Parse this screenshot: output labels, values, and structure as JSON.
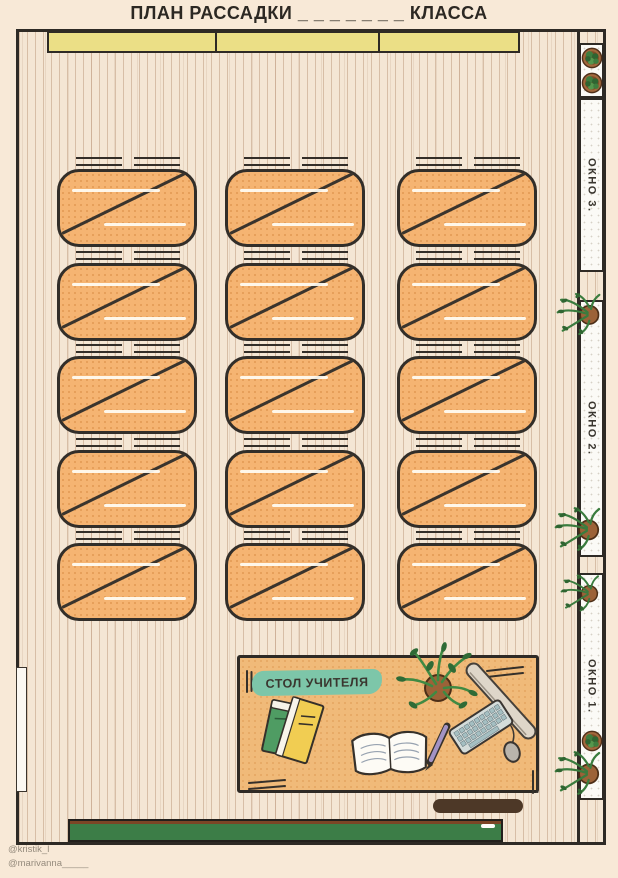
{
  "title": "ПЛАН РАССАДКИ _ _ _ _ _ _ _ КЛАССА",
  "classroom": {
    "windows": [
      {
        "label": "ОКНО 3."
      },
      {
        "label": "ОКНО 2."
      },
      {
        "label": "ОКНО 1."
      }
    ],
    "teacher_desk_label": "СТОЛ УЧИТЕЛЯ",
    "desk_grid": {
      "rows": 5,
      "columns": 3,
      "desks_total": 15,
      "seats_per_desk": 2
    }
  },
  "credits": [
    "@kristik_l",
    "@marivanna_____"
  ],
  "colors": {
    "desk_fill": "#f5b472",
    "band_yellow": "#ebdf86",
    "teal_label": "#7dc6a9",
    "board_green": "#3c7d47",
    "plant_green": "#3a7c3e",
    "floor": "#f4e6d4"
  }
}
